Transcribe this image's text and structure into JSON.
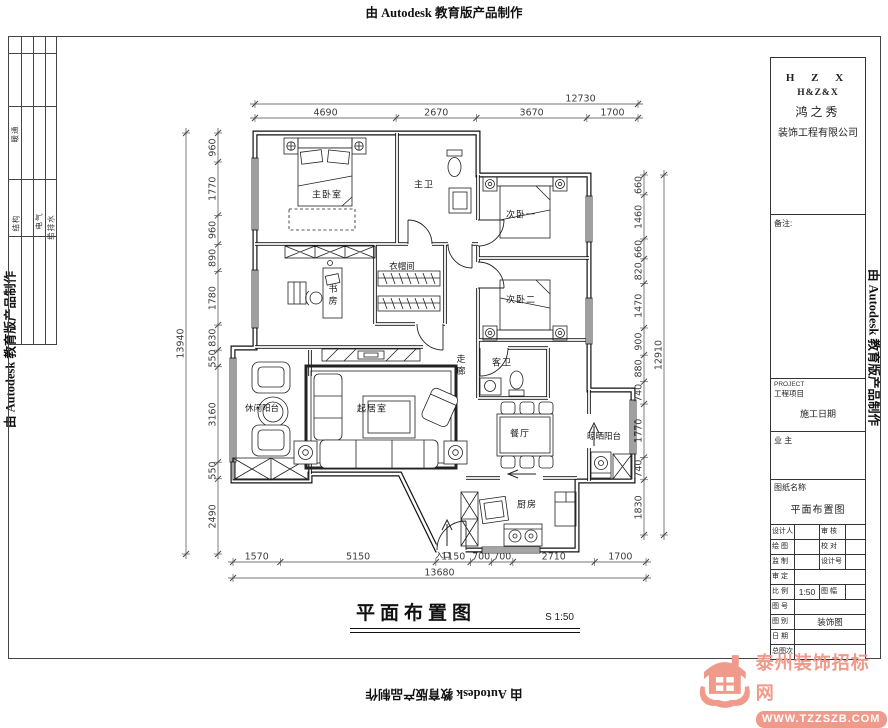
{
  "stamps": {
    "autodesk": "由 Autodesk 教育版产品制作"
  },
  "plan": {
    "rooms": {
      "master_bedroom": "主卧室",
      "master_bath": "主卫",
      "bedroom2": "次卧一",
      "bedroom3": "次卧二",
      "cloakroom": "衣帽间",
      "study": "书房",
      "corridor": "走廊",
      "guest_bath": "客卫",
      "leisure_balcony": "休闲阳台",
      "living_room": "起居室",
      "dining_room": "餐厅",
      "drying_balcony": "晾晒阳台",
      "kitchen": "厨房",
      "entrance": "入口"
    },
    "title": "平面布置图",
    "scale": "S 1:50",
    "dimensions": {
      "top": {
        "overall": "12730",
        "segments": [
          "4690",
          "2670",
          "3670",
          "1700"
        ]
      },
      "bottom": {
        "overall": "13680",
        "segments": [
          "1570",
          "5150",
          "1150",
          "700",
          "700",
          "2710",
          "1700"
        ]
      },
      "left": {
        "overall": "13940",
        "segments": [
          "960",
          "1770",
          "960",
          "890",
          "1780",
          "830",
          "550",
          "3160",
          "550",
          "2490"
        ]
      },
      "right": {
        "overall": "12910",
        "segments": [
          "660",
          "1460",
          "660",
          "820",
          "1470",
          "900",
          "880",
          "740",
          "1770",
          "740",
          "1830"
        ]
      }
    }
  },
  "disciplines": [
    "暖通",
    "结构",
    "电气",
    "给排水"
  ],
  "title_block": {
    "company": {
      "line1": "H Z X",
      "line2": "H&Z&X",
      "line3": "鸿之秀",
      "line4": "装饰工程有限公司"
    },
    "notes_label": "备注:",
    "project_en": "PROJECT",
    "project_label": "工程项目",
    "project_value": "施工日期",
    "owner_label": "业 主",
    "dwg_name_label": "图纸名称",
    "dwg_name": "平面布置图",
    "rows": [
      {
        "l1": "设计人",
        "v1": "",
        "l2": "审 核",
        "v2": ""
      },
      {
        "l1": "绘 图",
        "v1": "",
        "l2": "校 对",
        "v2": ""
      },
      {
        "l1": "监 制",
        "v1": "",
        "l2": "设计号",
        "v2": ""
      },
      {
        "l1": "审 定",
        "v1": ""
      },
      {
        "l1": "比 例",
        "v1": "1:50",
        "l2": "图 幅",
        "v2": ""
      },
      {
        "l1": "图 号",
        "v1": ""
      },
      {
        "l1": "图 别",
        "v1": "装饰图"
      },
      {
        "l1": "日 期",
        "v1": ""
      },
      {
        "l1": "总图次",
        "v1": ""
      }
    ]
  },
  "watermark": {
    "name": "泰州装饰招标网",
    "url": "WWW.TZZSZB.COM",
    "color": "#ef9a8a"
  }
}
